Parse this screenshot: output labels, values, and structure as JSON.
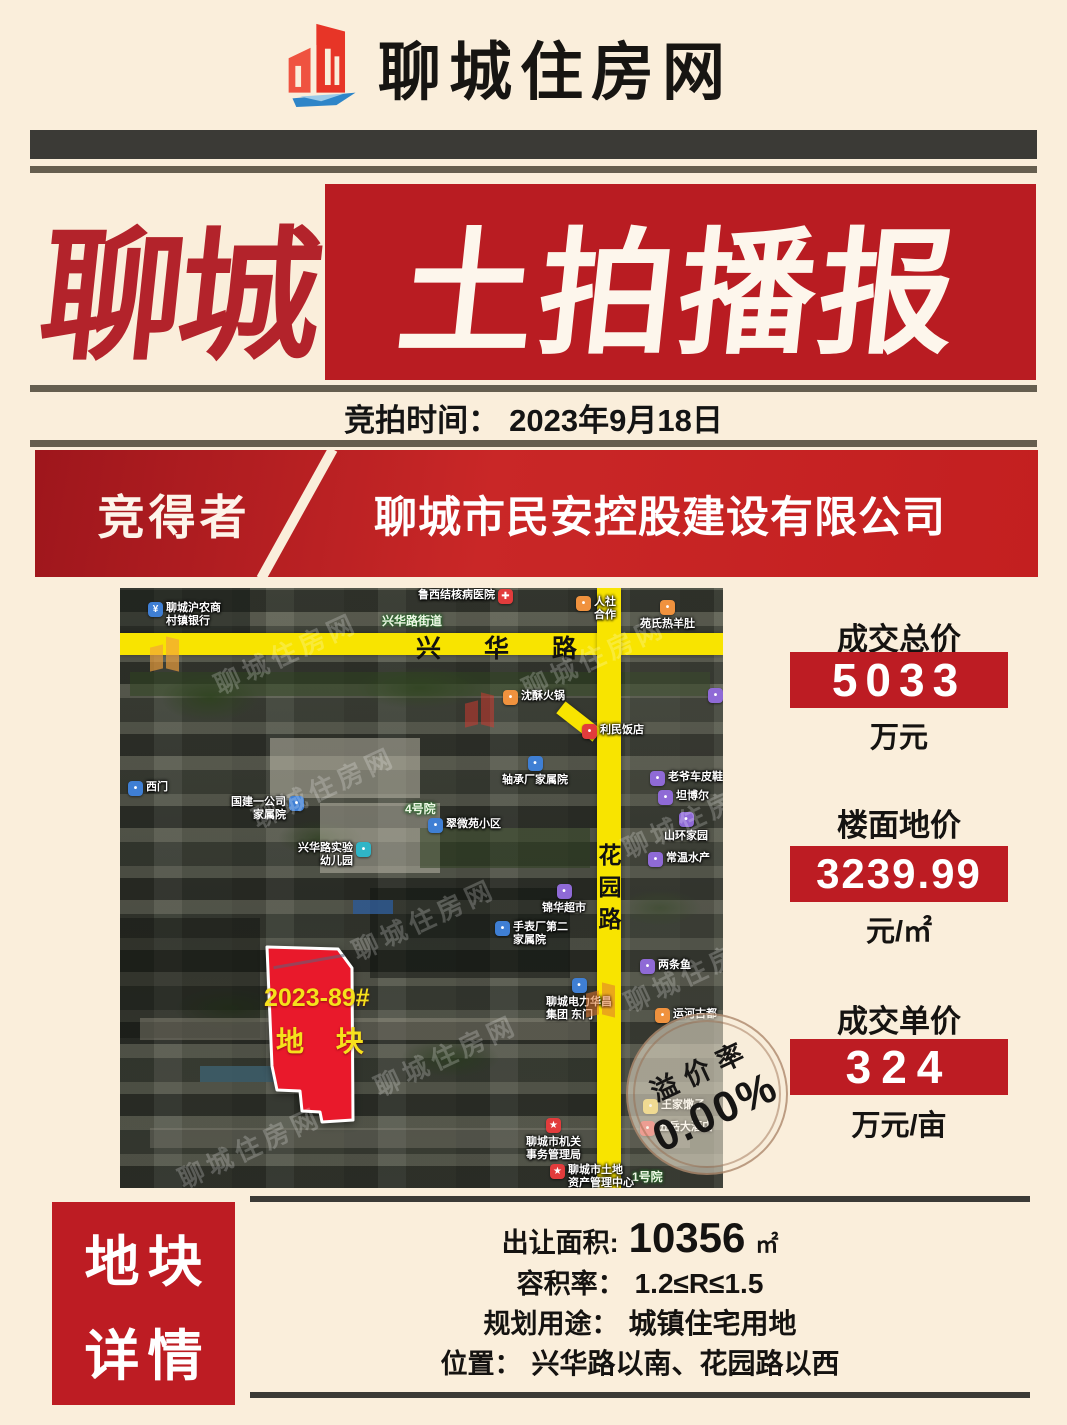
{
  "header": {
    "title": "聊城住房网",
    "logo": "liaocheng-housing-logo"
  },
  "hero": {
    "left": "聊城",
    "right": "土拍播报"
  },
  "auction": {
    "label": "竞拍时间：",
    "date": "2023年9月18日"
  },
  "winner": {
    "label": "竞得者",
    "company": "聊城市民安控股建设有限公司"
  },
  "stats": [
    {
      "label": "成交总价",
      "value": "5033",
      "unit": "万元"
    },
    {
      "label": "楼面地价",
      "value": "3239.99",
      "unit": "元/㎡"
    },
    {
      "label": "成交单价",
      "value": "324",
      "unit": "万元/亩"
    }
  ],
  "stamp": {
    "label": "溢价率",
    "value": "0.00%"
  },
  "details": {
    "title_line1": "地块",
    "title_line2": "详情",
    "rows": [
      {
        "label": "出让面积:",
        "value": "10356",
        "unit": "㎡"
      },
      {
        "label": "容积率：",
        "value": "1.2≤R≤1.5",
        "unit": ""
      },
      {
        "label": "规划用途：",
        "value": "城镇住宅用地",
        "unit": ""
      },
      {
        "label": "位置：",
        "value": "兴华路以南、花园路以西",
        "unit": ""
      }
    ]
  },
  "map": {
    "road_horizontal": "兴 华 路",
    "road_vertical": [
      "花",
      "园",
      "路"
    ],
    "parcel": {
      "line1": "2023-89#",
      "line2": "地 块"
    },
    "watermark": "聊城住房网",
    "area_labels": [
      {
        "text": "兴华路街道",
        "x": 262,
        "y": 24
      },
      {
        "text": "4号院",
        "x": 285,
        "y": 212
      },
      {
        "text": "1号院",
        "x": 512,
        "y": 580
      }
    ],
    "pois": [
      {
        "x": 28,
        "y": 14,
        "c": "#3f7fd4",
        "g": "¥",
        "lay": "right",
        "lines": [
          "聊城沪农商",
          "村镇银行"
        ]
      },
      {
        "x": 377,
        "y": 1,
        "c": "#e23c3c",
        "g": "✚",
        "lay": "left",
        "lines": [
          "鲁西结核病医院"
        ]
      },
      {
        "x": 456,
        "y": 8,
        "c": "#f0923e",
        "g": "•",
        "lay": "right",
        "lines": [
          "人社",
          "合作"
        ]
      },
      {
        "x": 546,
        "y": 12,
        "c": "#f0923e",
        "g": "•",
        "lay": "below",
        "lines": [
          "苑氏热羊肚"
        ]
      },
      {
        "x": 588,
        "y": 100,
        "c": "#8f6ad6",
        "g": "•",
        "lay": "right",
        "lines": [
          "魔方城"
        ]
      },
      {
        "x": 383,
        "y": 102,
        "c": "#f0923e",
        "g": "•",
        "lay": "right",
        "lines": [
          "沈酥火锅"
        ]
      },
      {
        "x": 462,
        "y": 136,
        "c": "#e23c3c",
        "g": "•",
        "lay": "right",
        "lines": [
          "利民饭店"
        ]
      },
      {
        "x": 408,
        "y": 168,
        "c": "#3f7fd4",
        "g": "•",
        "lay": "below",
        "lines": [
          "轴承厂家属院"
        ]
      },
      {
        "x": 530,
        "y": 183,
        "c": "#8f6ad6",
        "g": "•",
        "lay": "right",
        "lines": [
          "老爷车皮鞋专安"
        ]
      },
      {
        "x": 8,
        "y": 193,
        "c": "#3f7fd4",
        "g": "•",
        "lay": "right",
        "lines": [
          "西门"
        ]
      },
      {
        "x": 168,
        "y": 208,
        "c": "#3f7fd4",
        "g": "•",
        "lay": "left",
        "lines": [
          "国建一公司",
          "家属院"
        ]
      },
      {
        "x": 308,
        "y": 230,
        "c": "#3f7fd4",
        "g": "•",
        "lay": "right",
        "lines": [
          "翠微苑小区"
        ]
      },
      {
        "x": 235,
        "y": 254,
        "c": "#2fb5c7",
        "g": "•",
        "lay": "left",
        "lines": [
          "兴华路实验",
          "幼儿园"
        ]
      },
      {
        "x": 538,
        "y": 202,
        "c": "#8f6ad6",
        "g": "•",
        "lay": "right",
        "lines": [
          "坦博尔"
        ]
      },
      {
        "x": 570,
        "y": 224,
        "c": "#8f6ad6",
        "g": "•",
        "lay": "below",
        "lines": [
          "山环家园"
        ]
      },
      {
        "x": 528,
        "y": 264,
        "c": "#8f6ad6",
        "g": "•",
        "lay": "right",
        "lines": [
          "常温水产"
        ]
      },
      {
        "x": 448,
        "y": 296,
        "c": "#8f6ad6",
        "g": "•",
        "lay": "below",
        "lines": [
          "锦华超市"
        ]
      },
      {
        "x": 375,
        "y": 333,
        "c": "#3f7fd4",
        "g": "•",
        "lay": "right",
        "lines": [
          "手表厂第二",
          "家属院"
        ]
      },
      {
        "x": 520,
        "y": 371,
        "c": "#8f6ad6",
        "g": "•",
        "lay": "right",
        "lines": [
          "两条鱼"
        ]
      },
      {
        "x": 452,
        "y": 390,
        "c": "#3f7fd4",
        "g": "•",
        "lay": "below",
        "lines": [
          "聊城电力华昌",
          "集团 东门"
        ]
      },
      {
        "x": 535,
        "y": 420,
        "c": "#f0923e",
        "g": "•",
        "lay": "right",
        "lines": [
          "运河古都"
        ]
      },
      {
        "x": 523,
        "y": 511,
        "c": "#e8c33c",
        "g": "•",
        "lay": "right",
        "lines": [
          "王家馓子"
        ]
      },
      {
        "x": 520,
        "y": 533,
        "c": "#e23c3c",
        "g": "•",
        "lay": "right",
        "lines": [
          "五岳大酒店"
        ]
      },
      {
        "x": 432,
        "y": 530,
        "c": "#e23c3c",
        "g": "★",
        "lay": "below",
        "lines": [
          "聊城市机关",
          "事务管理局"
        ]
      },
      {
        "x": 430,
        "y": 576,
        "c": "#e23c3c",
        "g": "★",
        "lay": "right",
        "lines": [
          "聊城市土地",
          "资产管理中心"
        ]
      }
    ],
    "watermark_positions": [
      {
        "x": 88,
        "y": 46
      },
      {
        "x": 396,
        "y": 50
      },
      {
        "x": 126,
        "y": 180
      },
      {
        "x": 226,
        "y": 312
      },
      {
        "x": 248,
        "y": 448
      },
      {
        "x": 496,
        "y": 210
      },
      {
        "x": 498,
        "y": 364
      },
      {
        "x": 52,
        "y": 540
      }
    ],
    "logo_watermarks": [
      {
        "x": 30,
        "y": 50,
        "color": "#f2a23c",
        "opacity": 0.65
      },
      {
        "x": 345,
        "y": 106,
        "color": "#d8392f",
        "opacity": 0.5
      },
      {
        "x": 466,
        "y": 396,
        "color": "#e07830",
        "opacity": 0.55
      }
    ]
  },
  "colors": {
    "accent_red": "#bd1c23",
    "hero_red": "#b91c22",
    "parcel_red": "#e9192b",
    "road_yellow": "#f8e400",
    "cream_bg": "#faeedb",
    "bar_dark": "#3b3a36",
    "rule_brown": "#655e4f",
    "parcel_text_yellow": "#f6e11c"
  }
}
